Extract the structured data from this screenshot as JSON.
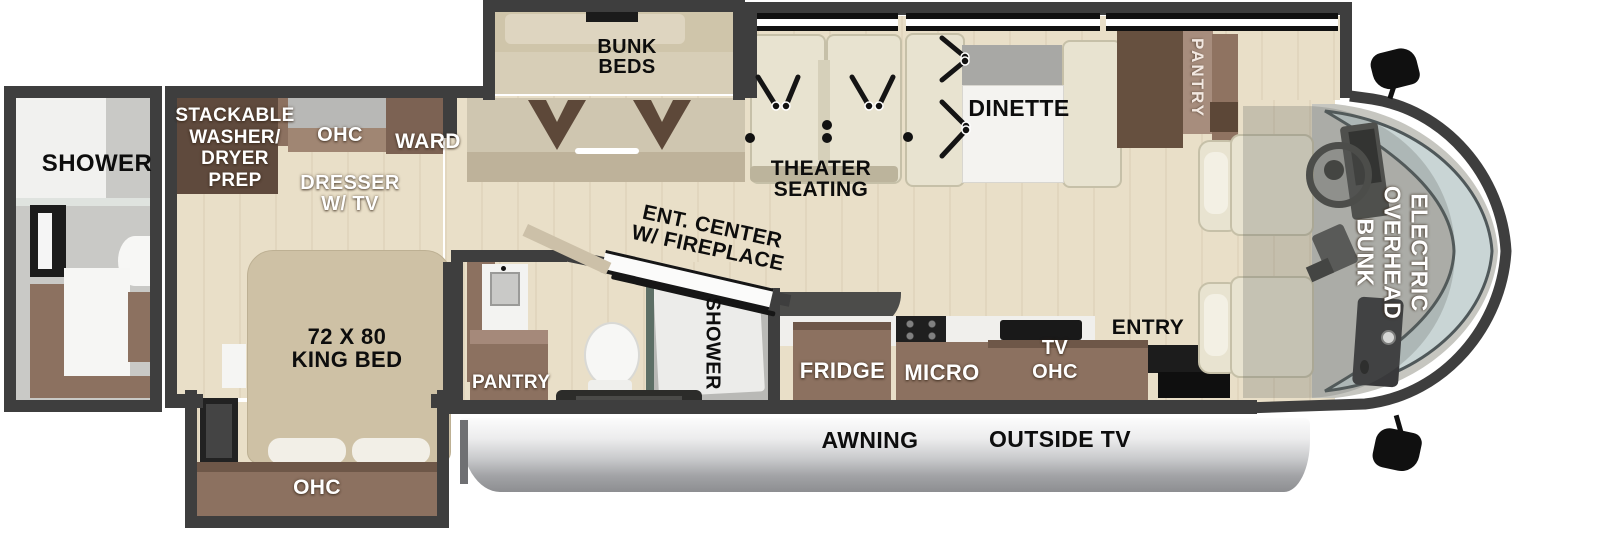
{
  "labels": {
    "rear_shower": "SHOWER",
    "washer_prep": [
      "STACKABLE",
      "WASHER/",
      "DRYER",
      "PREP"
    ],
    "ohc_bedroom": "OHC",
    "ward": "WARD",
    "dresser": [
      "DRESSER",
      "W/ TV"
    ],
    "king_bed": [
      "72 X 80",
      "KING BED"
    ],
    "ohc_bed_slide": "OHC",
    "bunk_beds": [
      "BUNK",
      "BEDS"
    ],
    "theater": [
      "THEATER",
      "SEATING"
    ],
    "ent_center": [
      "ENT. CENTER",
      "W/ FIREPLACE"
    ],
    "dinette": "DINETTE",
    "pantry_tall": "PANTRY",
    "pantry_bath": "PANTRY",
    "shower_bath": "SHOWER",
    "fridge": "FRIDGE",
    "micro": "MICRO",
    "tv": "TV",
    "ohc_kitchen": "OHC",
    "entry": "ENTRY",
    "overhead_bunk": [
      "ELECTRIC",
      "OVERHEAD",
      "BUNK"
    ],
    "awning": "AWNING",
    "outside_tv": "OUTSIDE TV"
  },
  "colors": {
    "wall": "#3e3e3e",
    "floor": "#e9dfc8",
    "cabinet": "#8c7160",
    "cabinet_dark": "#5f4a3d",
    "bed": "#cec1a5",
    "seat_cream": "#e8e3d0",
    "marble": "#f4f3f1",
    "awning_silver": "#c2c3c5",
    "windshield": "#c9d5d5",
    "label_dark": "#0d0d0d",
    "label_light": "#ffffff"
  }
}
